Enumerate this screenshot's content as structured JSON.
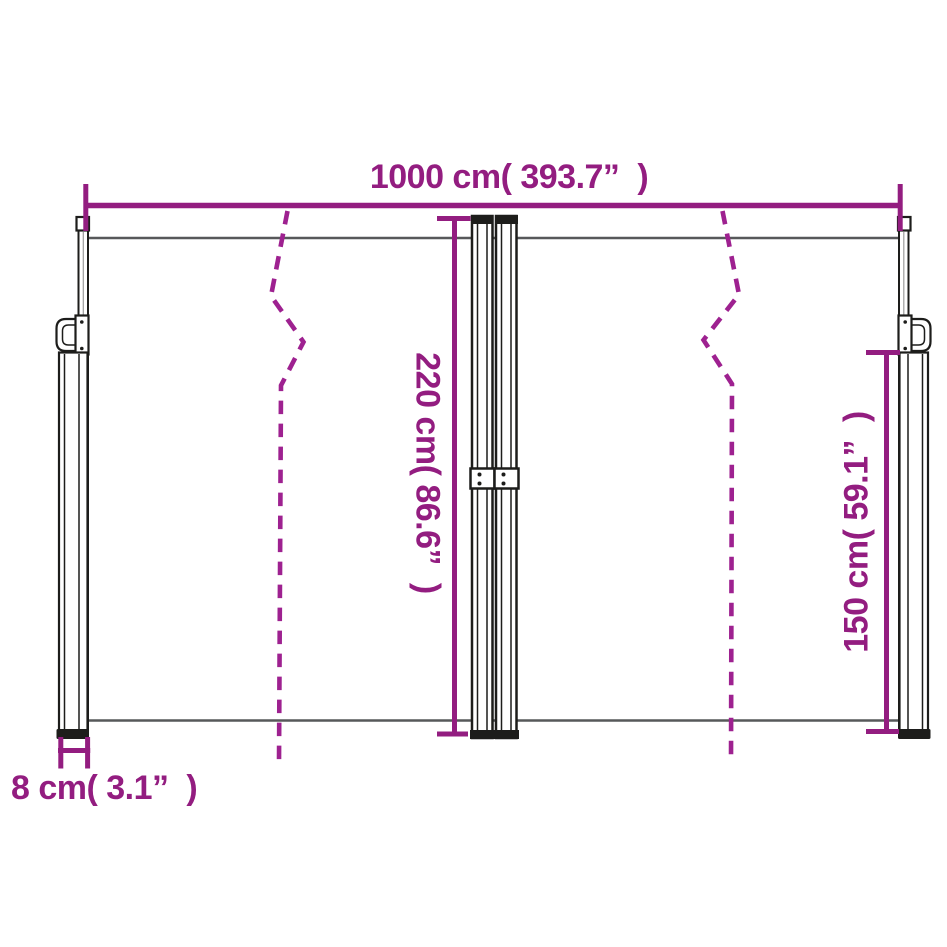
{
  "labels": {
    "width_total": "1000 cm( 393.7”  )",
    "height_center": "220 cm( 86.6”  )",
    "height_side": "150 cm( 59.1”  )",
    "base_width": "8 cm( 3.1”  )"
  },
  "colors": {
    "dimension": "#931d80",
    "dashed_line": "#9e2190",
    "fabric_line": "#57585a",
    "outline": "#1d1d1b",
    "background": "#ffffff"
  }
}
